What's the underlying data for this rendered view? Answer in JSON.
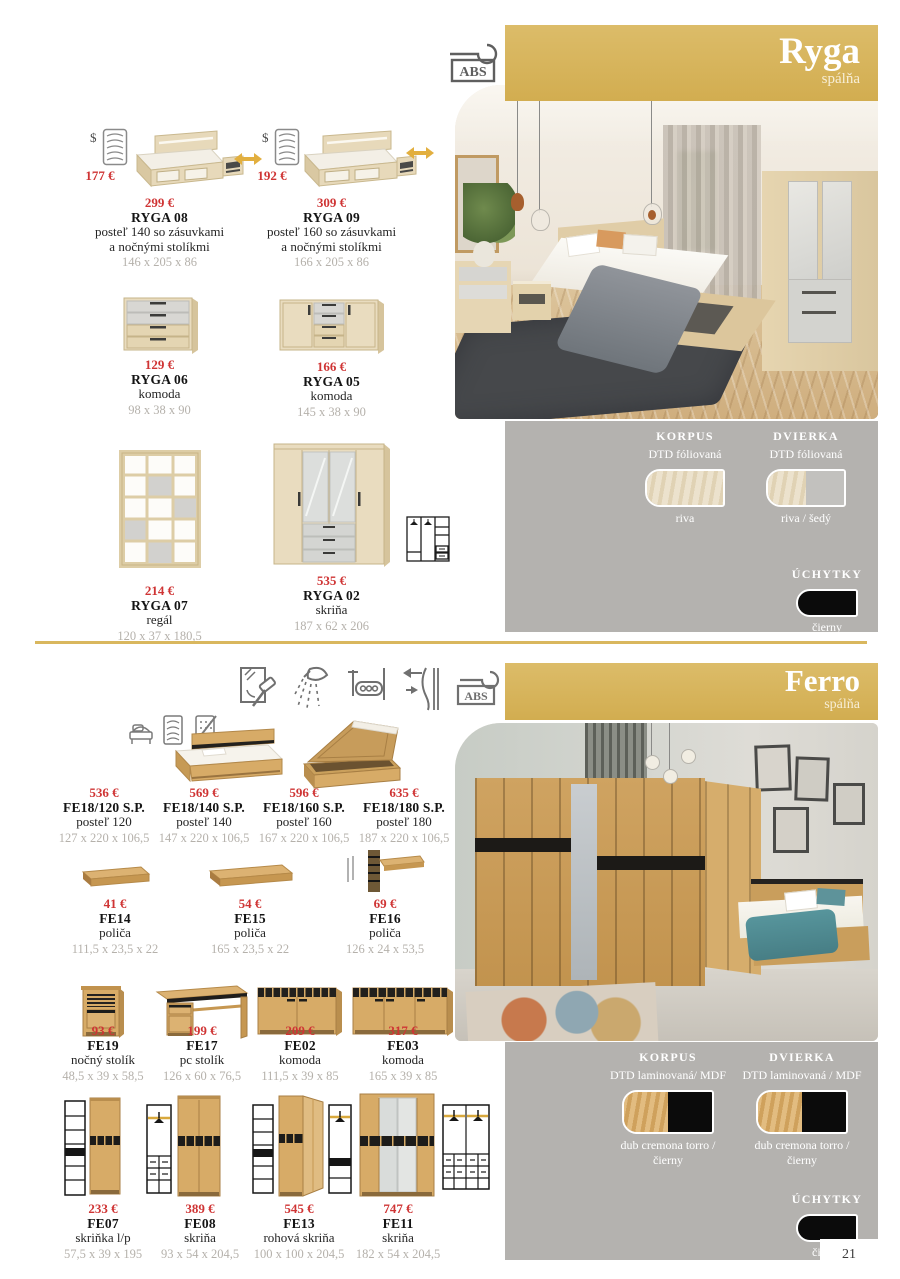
{
  "page_number": "21",
  "colors": {
    "accent_gold": "#d6b25c",
    "price_red": "#cf3434",
    "panel_gray": "#b4b2af",
    "riva_wood": "#e8dcc1",
    "swatch_gray": "#bfbebb",
    "cremona_wood": "#d7ab67",
    "handle_black": "#0d0d0d"
  },
  "ryga": {
    "title": "Ryga",
    "subtitle": "spálňa",
    "abs_label": "ABS",
    "products": [
      {
        "dollar": "$",
        "mattress_price": "177 €",
        "price": "299 €",
        "code": "RYGA 08",
        "desc1": "posteľ 140 so zásuvkami",
        "desc2": "a nočnými stolíkmi",
        "dims": "146 x 205 x 86"
      },
      {
        "dollar": "$",
        "mattress_price": "192 €",
        "price": "309 €",
        "code": "RYGA 09",
        "desc1": "posteľ 160 so zásuvkami",
        "desc2": "a nočnými stolíkmi",
        "dims": "166 x 205 x 86"
      },
      {
        "price": "129 €",
        "code": "RYGA 06",
        "desc1": "komoda",
        "dims": "98 x 38 x 90"
      },
      {
        "price": "166 €",
        "code": "RYGA 05",
        "desc1": "komoda",
        "dims": "145 x 38 x 90"
      },
      {
        "price": "214 €",
        "code": "RYGA 07",
        "desc1": "regál",
        "dims": "120 x 37 x 180,5"
      },
      {
        "price": "535 €",
        "code": "RYGA 02",
        "desc1": "skriňa",
        "dims": "187 x 62 x 206"
      }
    ],
    "materials": {
      "korpus_heading": "KORPUS",
      "korpus_material": "DTD fóliovaná",
      "korpus_label": "riva",
      "dvierka_heading": "DVIERKA",
      "dvierka_material": "DTD fóliovaná",
      "dvierka_label": "riva / šedý",
      "uchytky_heading": "ÚCHYTKY",
      "uchytky_label1": "čierny",
      "uchytky_label2": "plastové"
    }
  },
  "ferro": {
    "title": "Ferro",
    "subtitle": "spálňa",
    "abs_label": "ABS",
    "feature_icons": [
      "glass-hammer-icon",
      "light-icon",
      "rollout-icon",
      "soft-close-icon",
      "abs-edge-icon"
    ],
    "bed_icons": [
      "storage-bed-icon",
      "mattress-icon",
      "no-mattress-icon"
    ],
    "products": [
      {
        "price": "536 €",
        "code": "FE18/120 S.P.",
        "desc1": "posteľ 120",
        "dims": "127 x 220 x 106,5"
      },
      {
        "price": "569 €",
        "code": "FE18/140 S.P.",
        "desc1": "posteľ 140",
        "dims": "147 x 220 x 106,5"
      },
      {
        "price": "596 €",
        "code": "FE18/160 S.P.",
        "desc1": "posteľ 160",
        "dims": "167 x 220 x 106,5"
      },
      {
        "price": "635 €",
        "code": "FE18/180 S.P.",
        "desc1": "posteľ 180",
        "dims": "187 x 220 x 106,5"
      },
      {
        "price": "41 €",
        "code": "FE14",
        "desc1": "poliča",
        "dims": "111,5 x 23,5 x 22"
      },
      {
        "price": "54 €",
        "code": "FE15",
        "desc1": "poliča",
        "dims": "165 x 23,5 x 22"
      },
      {
        "price": "69 €",
        "code": "FE16",
        "desc1": "poliča",
        "dims": "126 x 24 x 53,5"
      },
      {
        "price": "93 €",
        "code": "FE19",
        "desc1": "nočný stolík",
        "dims": "48,5 x 39 x 58,5"
      },
      {
        "price": "199 €",
        "code": "FE17",
        "desc1": "pc stolík",
        "dims": "126 x 60 x 76,5"
      },
      {
        "price": "209 €",
        "code": "FE02",
        "desc1": "komoda",
        "dims": "111,5 x 39 x 85"
      },
      {
        "price": "317 €",
        "code": "FE03",
        "desc1": "komoda",
        "dims": "165 x 39 x 85"
      },
      {
        "price": "233 €",
        "code": "FE07",
        "desc1": "skriňka l/p",
        "dims": "57,5 x 39 x 195"
      },
      {
        "price": "389 €",
        "code": "FE08",
        "desc1": "skriňa",
        "dims": "93 x 54 x 204,5"
      },
      {
        "price": "545 €",
        "code": "FE13",
        "desc1": "rohová skriňa",
        "dims": "100 x 100 x 204,5"
      },
      {
        "price": "747 €",
        "code": "FE11",
        "desc1": "skriňa",
        "dims": "182 x 54 x 204,5"
      }
    ],
    "materials": {
      "korpus_heading": "KORPUS",
      "korpus_material": "DTD laminovaná/ MDF",
      "korpus_label1": "dub cremona torro /",
      "korpus_label2": "čierny",
      "dvierka_heading": "DVIERKA",
      "dvierka_material": "DTD laminovaná / MDF",
      "dvierka_label1": "dub cremona torro /",
      "dvierka_label2": "čierny",
      "uchytky_heading": "ÚCHYTKY",
      "uchytky_label1": "čierny",
      "uchytky_label2": "hliníková"
    }
  }
}
